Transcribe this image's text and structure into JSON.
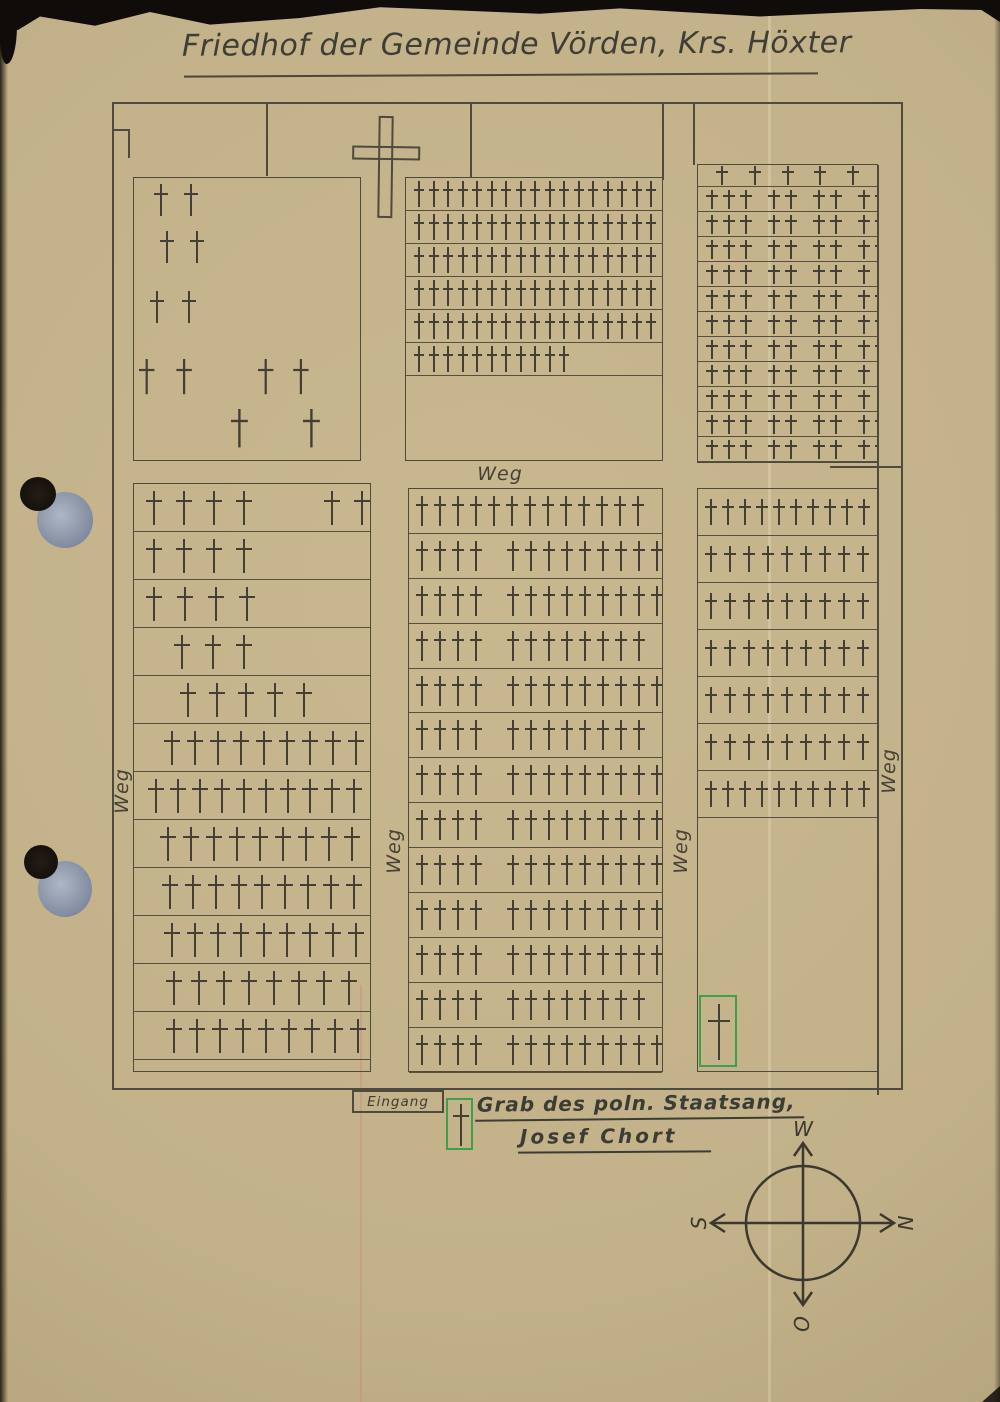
{
  "page": {
    "title": "Friedhof der Gemeinde Vörden, Krs. Höxter"
  },
  "plan": {
    "paths": {
      "top": "Weg",
      "left": "Weg",
      "middle": "Weg",
      "inner_right": "Weg",
      "right": "Weg"
    },
    "entrance_label": "Eingang",
    "note": {
      "line1": "Grab des poln. Staatsang,",
      "line2": "Josef Chort"
    },
    "compass": {
      "top": "W",
      "right": "N",
      "left": "S",
      "bottom": "O"
    },
    "blocks": {
      "chapel_field": {
        "graves": [
          {
            "x": 20,
            "y": 6,
            "n": 2,
            "sp": 16,
            "s": 1
          },
          {
            "x": 26,
            "y": 53,
            "n": 2,
            "sp": 16,
            "s": 1
          },
          {
            "x": 16,
            "y": 113,
            "n": 2,
            "sp": 18,
            "s": 1
          },
          {
            "x": 5,
            "y": 181,
            "n": 2,
            "sp": 20,
            "s": 1.1
          },
          {
            "x": 124,
            "y": 181,
            "n": 2,
            "sp": 18,
            "s": 1.1
          },
          {
            "x": 97,
            "y": 231,
            "n": 2,
            "sp": 46,
            "s": 1.2
          }
        ]
      },
      "top_middle": {
        "rows": [
          {
            "n": 17
          },
          {
            "n": 17
          },
          {
            "n": 17
          },
          {
            "n": 17
          },
          {
            "n": 17
          },
          {
            "n": 11
          }
        ]
      },
      "top_right": {
        "rows": [
          {
            "n": 5,
            "sparse": true,
            "h": 22
          },
          {
            "n": 9
          },
          {
            "n": 9
          },
          {
            "n": 9
          },
          {
            "n": 8
          },
          {
            "n": 9
          },
          {
            "n": 9
          },
          {
            "n": 9
          },
          {
            "n": 8
          },
          {
            "n": 8
          },
          {
            "n": 9
          },
          {
            "n": 9
          }
        ]
      },
      "bottom_left": {
        "rows": [
          {
            "n": 4,
            "r": 2,
            "sp": 14
          },
          {
            "n": 4,
            "sp": 14
          },
          {
            "n": 4,
            "sp": 15
          },
          {
            "n": 3,
            "sp": 15,
            "pad": 40
          },
          {
            "n": 5,
            "sp": 13,
            "pad": 46
          },
          {
            "n": 9,
            "sp": 7,
            "pad": 30
          },
          {
            "n": 10,
            "sp": 6,
            "pad": 14
          },
          {
            "n": 9,
            "sp": 7,
            "pad": 26
          },
          {
            "n": 9,
            "sp": 7,
            "pad": 28
          },
          {
            "n": 9,
            "sp": 7,
            "pad": 30
          },
          {
            "n": 8,
            "sp": 9,
            "pad": 32
          },
          {
            "n": 9,
            "sp": 7,
            "pad": 32
          }
        ]
      },
      "bottom_middle": {
        "rows": [
          {
            "n": 13
          },
          {
            "a": 4,
            "b": 9
          },
          {
            "a": 4,
            "b": 9
          },
          {
            "a": 4,
            "b": 8
          },
          {
            "a": 4,
            "b": 9
          },
          {
            "a": 4,
            "b": 8
          },
          {
            "a": 4,
            "b": 9
          },
          {
            "a": 4,
            "b": 9
          },
          {
            "a": 4,
            "b": 9
          },
          {
            "a": 4,
            "b": 9
          },
          {
            "a": 4,
            "b": 9
          },
          {
            "a": 4,
            "b": 8
          },
          {
            "a": 4,
            "b": 9
          }
        ]
      },
      "bottom_right": {
        "rows": [
          {
            "n": 10,
            "sp": 5
          },
          {
            "n": 9,
            "sp": 7
          },
          {
            "n": 9,
            "sp": 7
          },
          {
            "n": 9,
            "sp": 7
          },
          {
            "n": 9,
            "sp": 7
          },
          {
            "n": 9,
            "sp": 7
          },
          {
            "n": 10,
            "sp": 5
          }
        ]
      }
    }
  },
  "colors": {
    "paper": "#c2b189",
    "ink": "#4f4a3e",
    "cross_ink": "#433f35",
    "accent_green": "#3fa04c",
    "hole_grey": "#8b95a8",
    "scan_background": "#0f0c09"
  }
}
